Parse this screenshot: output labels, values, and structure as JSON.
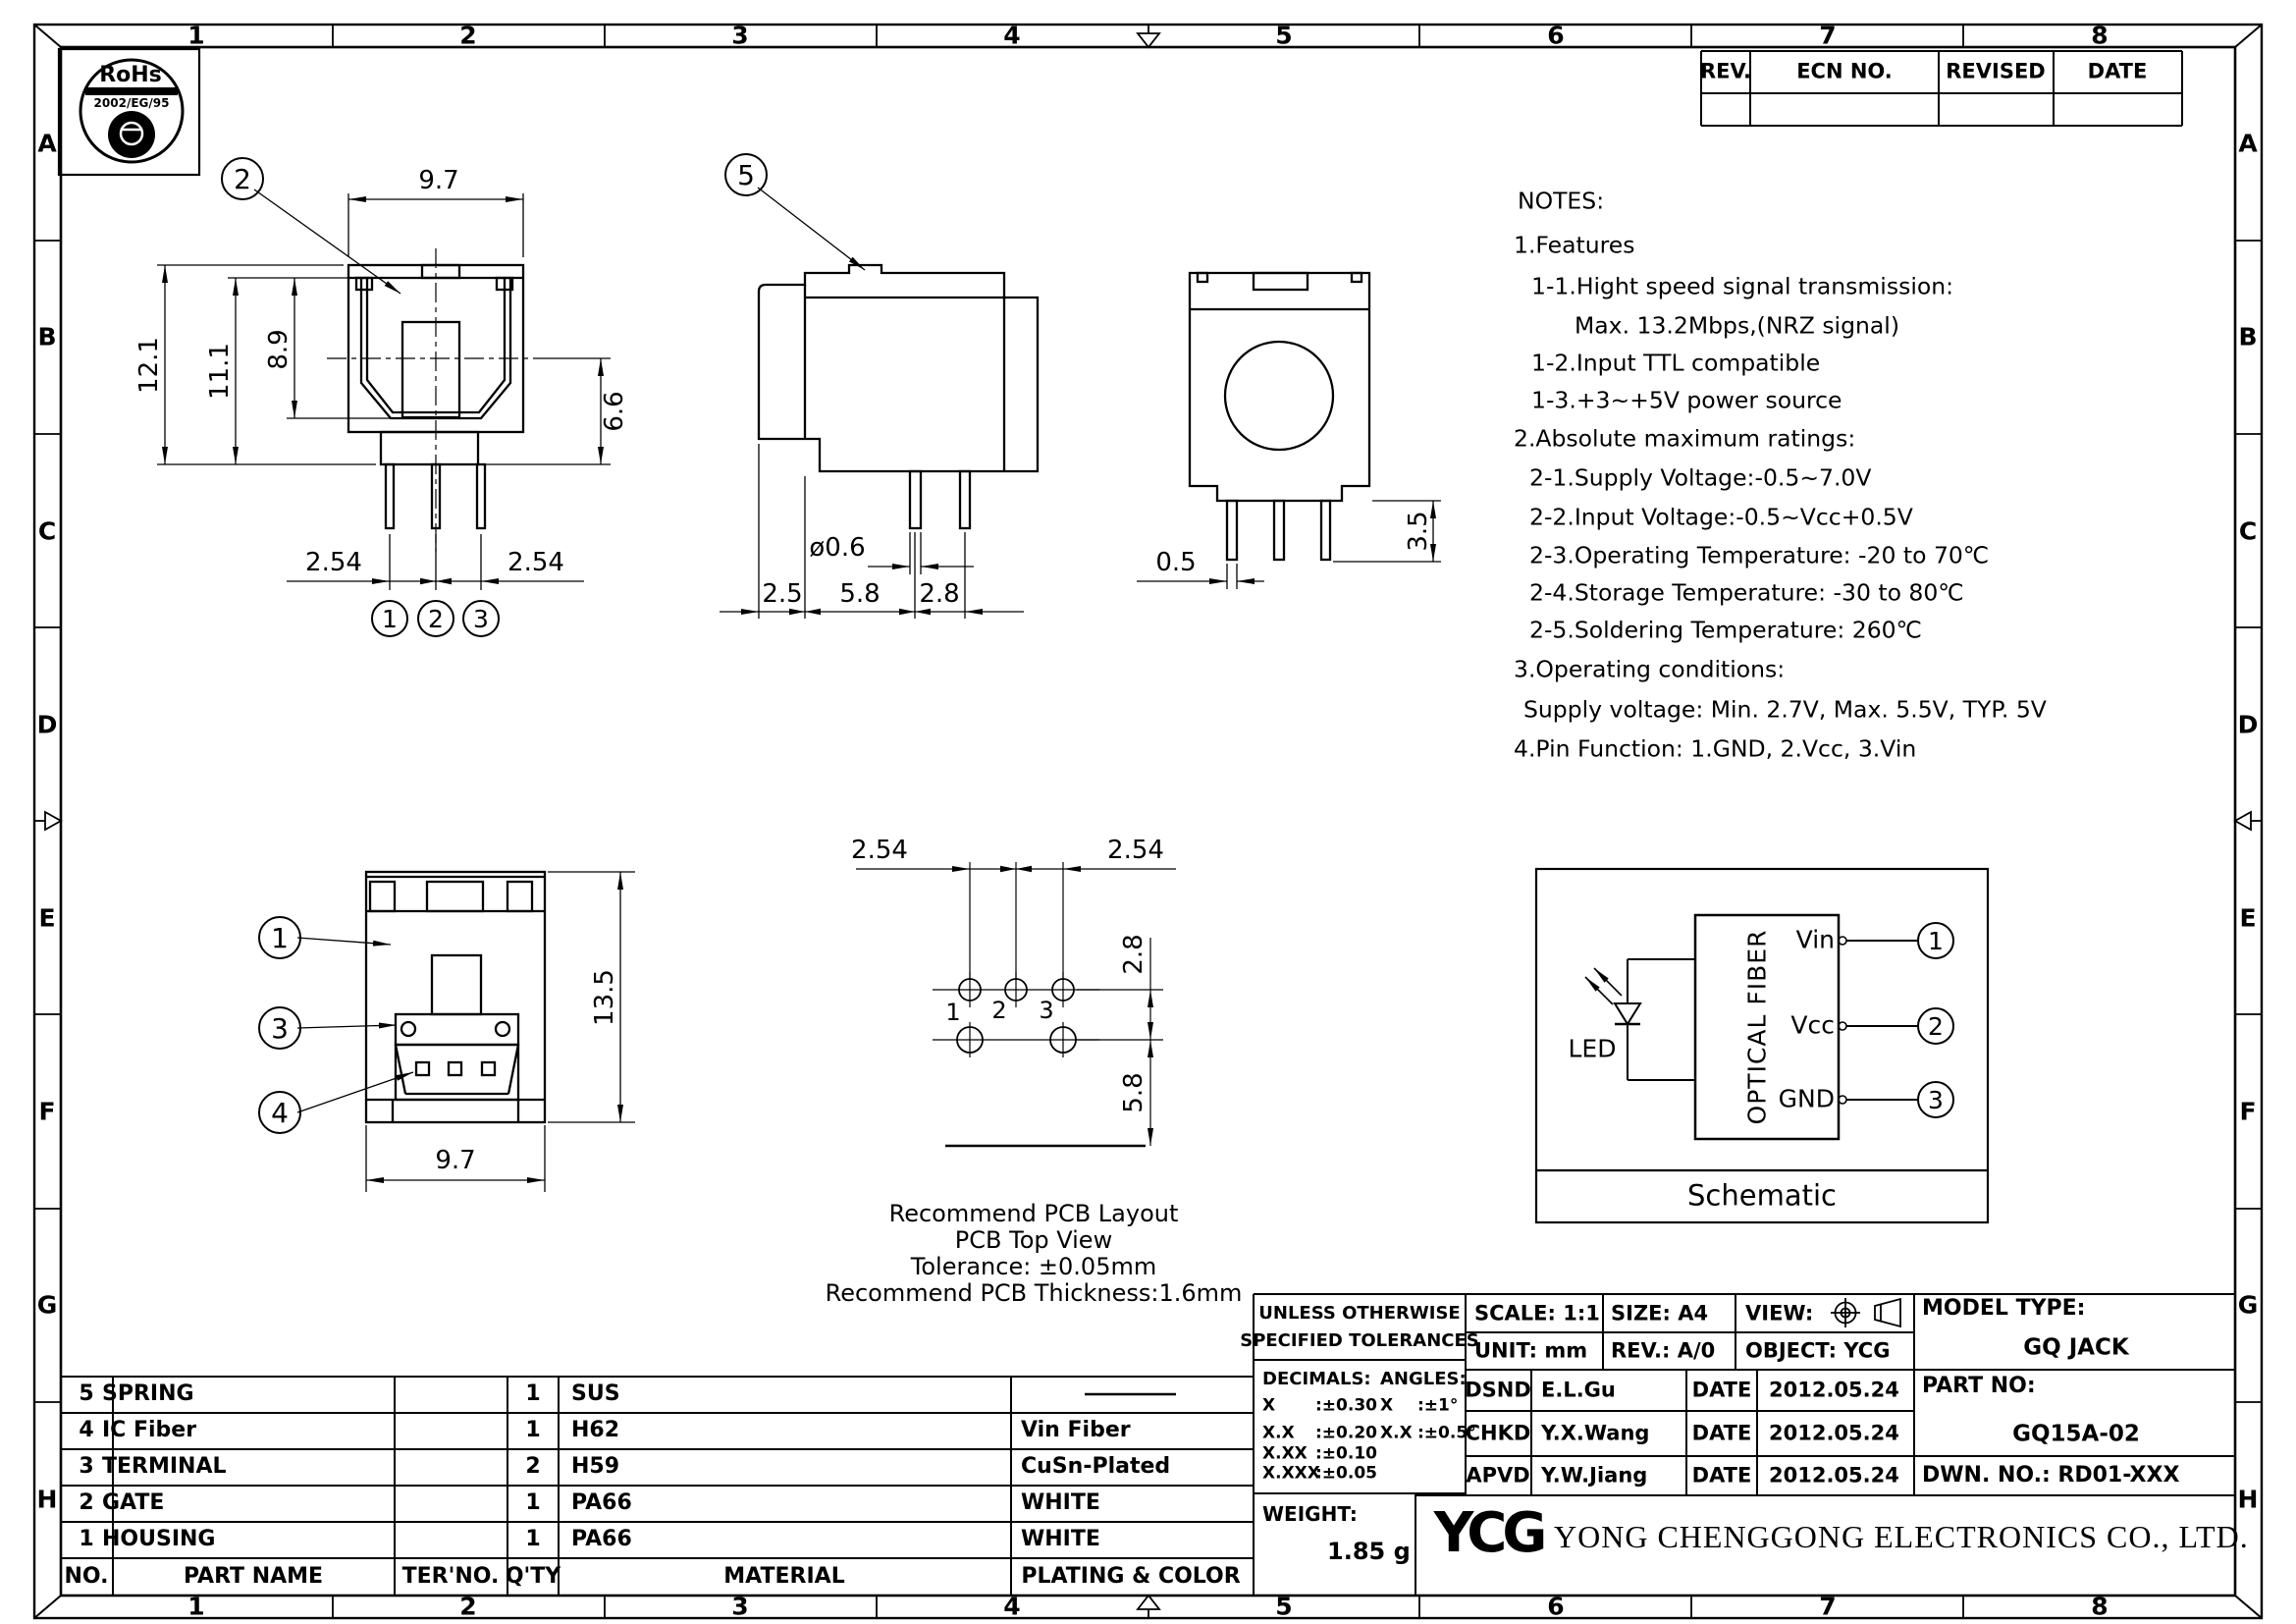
{
  "frame": {
    "cols": [
      "1",
      "2",
      "3",
      "4",
      "5",
      "6",
      "7",
      "8"
    ],
    "rows": [
      "A",
      "B",
      "C",
      "D",
      "E",
      "F",
      "G",
      "H"
    ]
  },
  "rohs": {
    "name": "RoHs",
    "standard": "2002/EG/95"
  },
  "rev_table": {
    "rev": "REV.",
    "ecn": "ECN NO.",
    "revised": "REVISED",
    "date": "DATE"
  },
  "notes": {
    "title": "NOTES:",
    "lines": [
      "1.Features",
      "1-1.Hight speed signal transmission:",
      "Max. 13.2Mbps,(NRZ signal)",
      "1-2.Input TTL compatible",
      "1-3.+3~+5V power source",
      "2.Absolute maximum ratings:",
      "2-1.Supply Voltage:-0.5~7.0V",
      "2-2.Input Voltage:-0.5~Vcc+0.5V",
      "2-3.Operating Temperature: -20 to 70℃",
      "2-4.Storage Temperature: -30 to 80℃",
      "2-5.Soldering Temperature: 260℃",
      "3.Operating conditions:",
      "Supply voltage: Min. 2.7V, Max. 5.5V, TYP. 5V",
      "4.Pin Function: 1.GND, 2.Vcc, 3.Vin"
    ]
  },
  "front": {
    "callout": "2",
    "width": "9.7",
    "height_total": "12.1",
    "height_body": "11.1",
    "height_opening": "8.9",
    "height_lower": "6.6",
    "pitch_left": "2.54",
    "pitch_right": "2.54",
    "pins": [
      "1",
      "2",
      "3"
    ]
  },
  "side": {
    "callout": "5",
    "pin_dia": "ø0.6",
    "flange": "2.5",
    "front_gap": "5.8",
    "row_gap": "2.8"
  },
  "back": {
    "pin_width": "0.5",
    "pin_length": "3.5"
  },
  "bottom": {
    "callouts": [
      "1",
      "3",
      "4"
    ],
    "height": "13.5",
    "width": "9.7"
  },
  "pcb": {
    "pitch_left": "2.54",
    "pitch_right": "2.54",
    "row_gap": "2.8",
    "edge_gap": "5.8",
    "pins": [
      "1",
      "2",
      "3"
    ],
    "captions": [
      "Recommend PCB Layout",
      "PCB Top View",
      "Tolerance: ±0.05mm",
      "Recommend PCB Thickness:1.6mm"
    ]
  },
  "schematic": {
    "led": "LED",
    "fiber": "OPTICAL FIBER",
    "pin_names": [
      "Vin",
      "Vcc",
      "GND"
    ],
    "pin_nums": [
      "1",
      "2",
      "3"
    ],
    "caption": "Schematic"
  },
  "parts": {
    "headers": {
      "no": "NO.",
      "name": "PART NAME",
      "ter": "TER'NO.",
      "qty": "Q'TY",
      "material": "MATERIAL",
      "plating": "PLATING & COLOR"
    },
    "rows": [
      {
        "no": "5",
        "name": "SPRING",
        "qty": "1",
        "material": "SUS",
        "plating": ""
      },
      {
        "no": "4",
        "name": "IC Fiber",
        "qty": "1",
        "material": "H62",
        "plating": "Vin Fiber"
      },
      {
        "no": "3",
        "name": "TERMINAL",
        "qty": "2",
        "material": "H59",
        "plating": "CuSn-Plated"
      },
      {
        "no": "2",
        "name": "GATE",
        "qty": "1",
        "material": "PA66",
        "plating": "WHITE"
      },
      {
        "no": "1",
        "name": "HOUSING",
        "qty": "1",
        "material": "PA66",
        "plating": "WHITE"
      }
    ]
  },
  "title_block": {
    "tol1": "UNLESS OTHERWISE",
    "tol2": "SPECIFIED TOLERANCES",
    "decimals_label": "DECIMALS:",
    "angles_label": "ANGLES:",
    "decimals": [
      {
        "k": "X",
        "v": ":±0.30"
      },
      {
        "k": "X.X",
        "v": ":±0.20"
      },
      {
        "k": "X.XX",
        "v": ":±0.10"
      },
      {
        "k": "X.XXX",
        "v": ":±0.05"
      }
    ],
    "angles": [
      {
        "k": "X",
        "v": ":±1°"
      },
      {
        "k": "X.X",
        "v": ":±0.5°"
      }
    ],
    "weight_label": "WEIGHT:",
    "weight": "1.85 g",
    "scale_label": "SCALE:",
    "scale": "1:1",
    "size_label": "SIZE:",
    "size": "A4",
    "view_label": "VIEW:",
    "unit_label": "UNIT:",
    "unit": "mm",
    "rev_label": "REV.:",
    "rev": "A/0",
    "object_label": "OBJECT:",
    "object": "YCG",
    "model_label": "MODEL TYPE:",
    "model": "GQ JACK",
    "part_label": "PART NO:",
    "part": "GQ15A-02",
    "dwn": "DWN. NO.: RD01-XXX",
    "signoff": [
      {
        "role": "DSND",
        "name": "E.L.Gu",
        "date_label": "DATE",
        "date": "2012.05.24"
      },
      {
        "role": "CHKD",
        "name": "Y.X.Wang",
        "date_label": "DATE",
        "date": "2012.05.24"
      },
      {
        "role": "APVD",
        "name": "Y.W.Jiang",
        "date_label": "DATE",
        "date": "2012.05.24"
      }
    ],
    "logo": "YCG",
    "company": "YONG CHENGGONG ELECTRONICS CO., LTD."
  }
}
